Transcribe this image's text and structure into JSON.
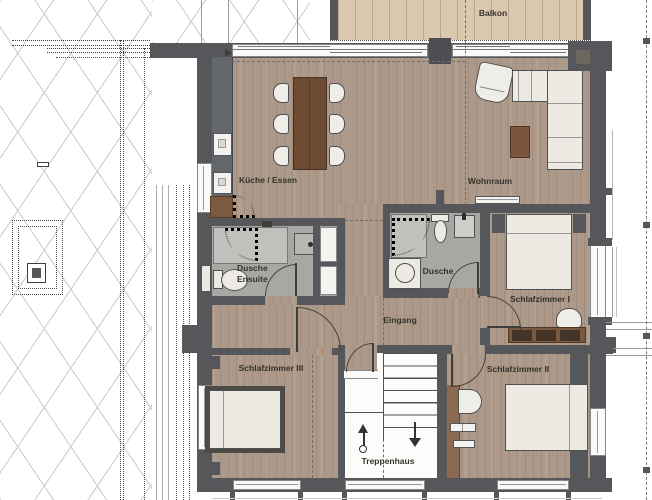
{
  "plan": {
    "type": "apartment-floor-plan",
    "language": "de"
  },
  "labels": {
    "balkon": "Balkon",
    "kueche_essen": "Küche / Essen",
    "wohnraum": "Wohnraum",
    "dusche_ensuite_line1": "Dusche",
    "dusche_ensuite_line2": "Ensuite",
    "dusche": "Dusche",
    "eingang": "Eingang",
    "schlafzimmer_1": "Schlafzimmer I",
    "schlafzimmer_2": "Schlafzimmer II",
    "schlafzimmer_3": "Schlafzimmer III",
    "treppenhaus": "Treppenhaus"
  },
  "colors": {
    "wall": "#55575a",
    "floor_wood": "#ac9989",
    "balcony_wood": "#dbc9af",
    "bath_floor": "#a8a7a4",
    "shower_floor": "#c1c0bd",
    "stair_floor": "#fcfcfb",
    "furniture_white": "#eceae3",
    "furniture_wood_dark": "#6d4b33",
    "kitchen_counter": "#63666a",
    "label_text": "#34322b",
    "lattice_line": "#c9c9c9"
  }
}
